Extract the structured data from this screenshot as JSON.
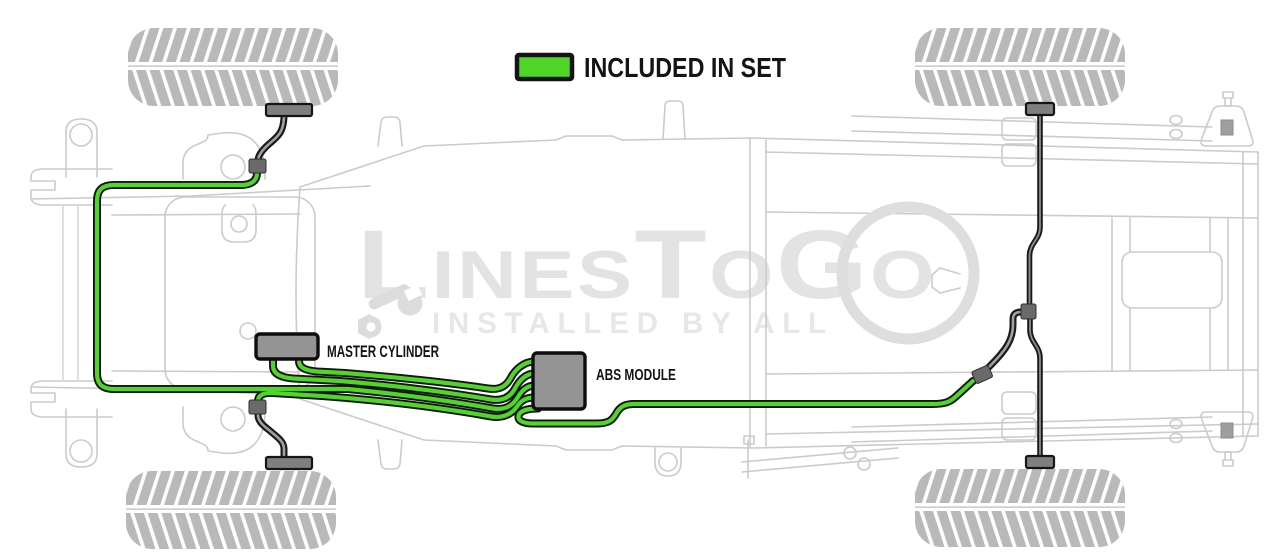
{
  "legend": {
    "label": "INCLUDED IN SET",
    "swatch_color": "#4fd628"
  },
  "labels": {
    "master_cylinder": "MASTER CYLINDER",
    "abs_module": "ABS MODULE"
  },
  "watermark": {
    "brand": "LinesToGo",
    "tagline": "INSTALLED BY ALL"
  },
  "colors": {
    "included_line": "#4fd628",
    "line_outline": "#141414",
    "excluded_line": "#8d8d8d",
    "chassis_outline": "#cbcbcb",
    "component_fill": "#949494",
    "tire_fill": "#b9b9b9",
    "watermark_text": "#e3e3e3",
    "label_text": "#141414"
  },
  "icons": {
    "wrench": "wrench-icon",
    "legend_swatch": "included-color-swatch"
  }
}
